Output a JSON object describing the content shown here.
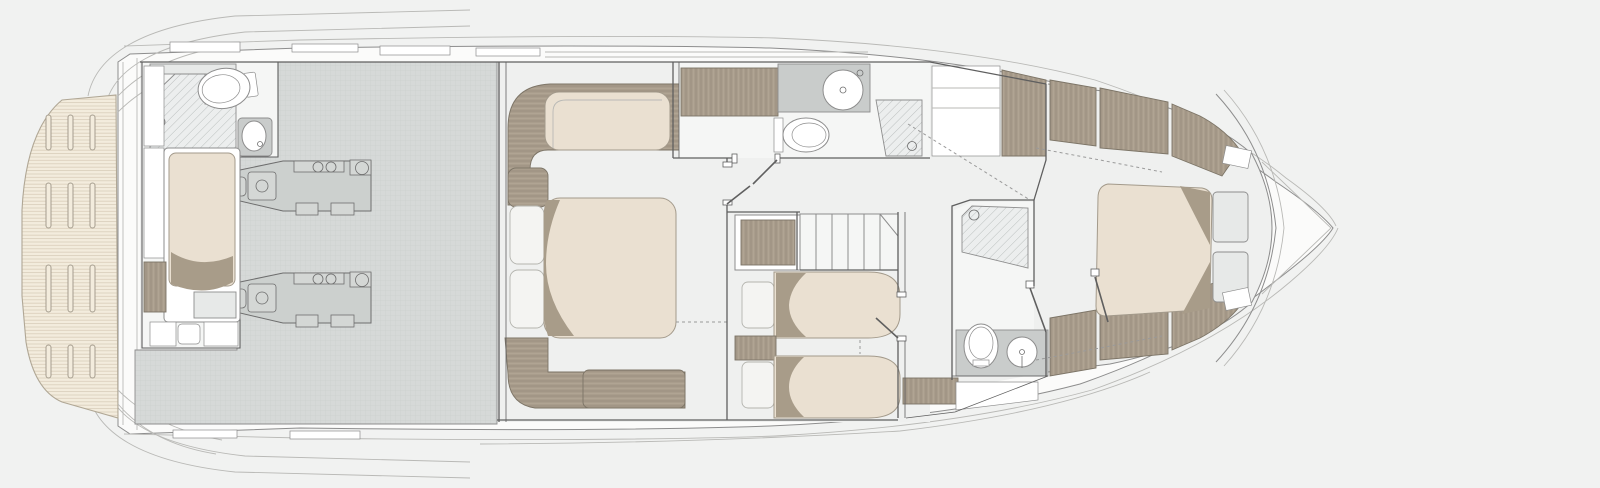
{
  "drawing": {
    "kind": "yacht-floor-plan",
    "deck": "lower-deck",
    "orientation": "bow-right"
  },
  "palette": {
    "bg": "#f1f2f1",
    "hull": "#fbfbfa",
    "floor": "#eff0ef",
    "roomLight": "#f5f6f5",
    "wall": "#5f5f5f",
    "line": "#8d8d8d",
    "faint": "#b9b9b6",
    "teak": "#f3ecdd",
    "teakLine": "#d9cdb9",
    "teakEdge": "#b0a795",
    "teakSlot": "#a59d8e",
    "engineRoom": "#d6d9d8",
    "grid": "#c8ccca",
    "engine": "#ccd0ce",
    "engine2": "#d4d7d5",
    "engineLine": "#6e6e6e",
    "wood": "#a89c8b",
    "woodGrain": "#93877a",
    "woodGrainLight": "#b7ac9c",
    "woodEdge": "#7c7466",
    "mattress": "#eae0d1",
    "mattressLine": "#a39a8b",
    "fold": "#a89c89",
    "pillow": "#f4f4f2",
    "pillowLine": "#b4b4ae",
    "counter": "#c9cccb",
    "cabinetGray": "#e7e9e8",
    "hatchBg": "#eceeee",
    "hatchLine": "#b6bab9",
    "fixture": "#ffffff",
    "dash": "#9a9a9a"
  },
  "regions": {
    "swim_platform": {
      "fixtures": [
        "teak-deck",
        "deck-slots"
      ]
    },
    "engine_room": {
      "fixtures": [
        "port-engine",
        "starboard-engine"
      ]
    },
    "crew_cabin": {
      "fixtures": [
        "single-berth",
        "wardrobe",
        "table",
        "toilet",
        "shower",
        "washbasin"
      ]
    },
    "master_cabin": {
      "fixtures": [
        "double-bed",
        "pillows",
        "sofa",
        "foot-bench"
      ]
    },
    "master_bathroom": {
      "fixtures": [
        "wood-vanity",
        "washbasin",
        "toilet",
        "shower"
      ]
    },
    "staircase": {
      "fixtures": [
        "steps"
      ]
    },
    "twin_cabin": {
      "fixtures": [
        "twin-bed-port",
        "twin-bed-starboard",
        "nightstand",
        "wardrobe",
        "drawers"
      ]
    },
    "forward_bathroom": {
      "fixtures": [
        "shower",
        "toilet",
        "washbasin",
        "cabinet"
      ]
    },
    "vip_cabin": {
      "fixtures": [
        "double-bed",
        "nightstand-port",
        "nightstand-starboard",
        "hull-wardrobes"
      ]
    },
    "bow": {
      "fixtures": [
        "anchor-locker"
      ]
    }
  }
}
